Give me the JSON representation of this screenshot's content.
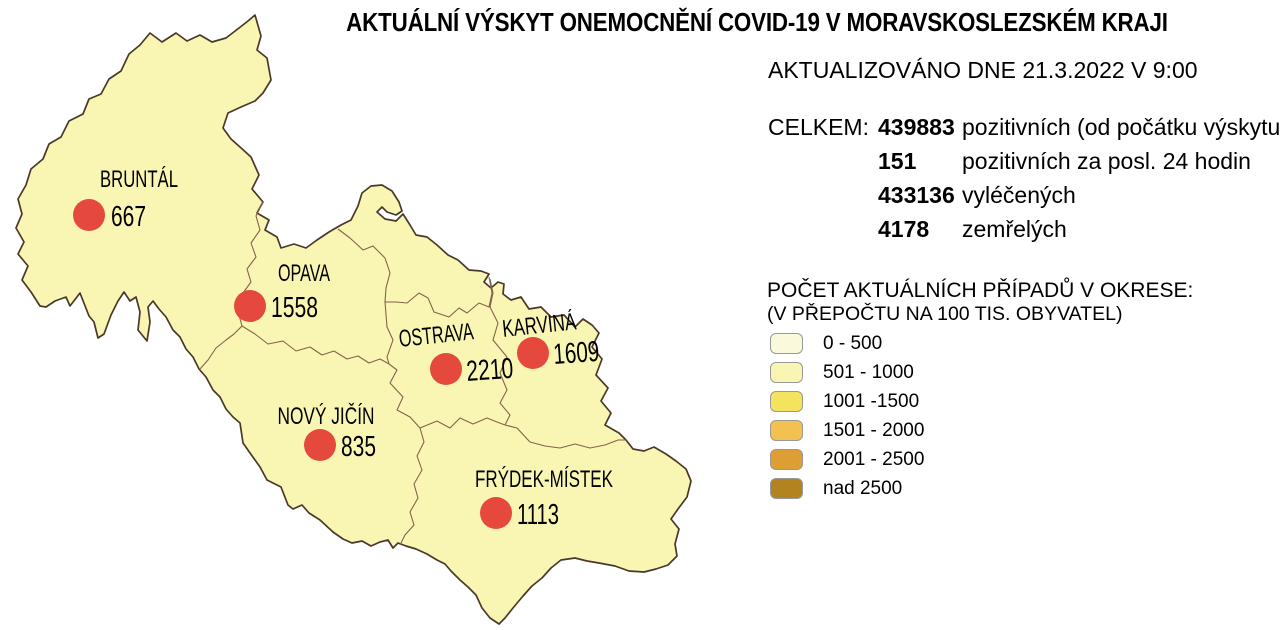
{
  "title": "AKTUÁLNÍ VÝSKYT ONEMOCNĚNÍ COVID-19 V MORAVSKOSLEZSKÉM KRAJI",
  "updated": "AKTUALIZOVÁNO DNE 21.3.2022 V 9:00",
  "totals": {
    "label": "CELKEM:",
    "rows": [
      {
        "value": "439883",
        "text": "pozitivních (od počátku výskytu)"
      },
      {
        "value": "151",
        "text": "pozitivních za posl. 24 hodin"
      },
      {
        "value": "433136",
        "text": "vyléčených"
      },
      {
        "value": "4178",
        "text": "zemřelých"
      }
    ]
  },
  "legend": {
    "title": "POČET AKTUÁLNÍCH PŘÍPADŮ V OKRESE:",
    "subtitle": "(V PŘEPOČTU NA 100 TIS. OBYVATEL)",
    "items": [
      {
        "label": "0 - 500",
        "color": "#FBF9DC"
      },
      {
        "label": "501 - 1000",
        "color": "#F9F6B4"
      },
      {
        "label": "1001 -1500",
        "color": "#F3E35F"
      },
      {
        "label": "1501 - 2000",
        "color": "#F2C14F"
      },
      {
        "label": "2001 - 2500",
        "color": "#DD9F35"
      },
      {
        "label": "nad 2500",
        "color": "#B3831F"
      }
    ]
  },
  "map": {
    "fill": "#F9F6B4",
    "border_color": "#4A3828",
    "district_border_color": "#84634A",
    "marker_color": "#E5483C",
    "districts": [
      {
        "name": "BRUNTÁL",
        "value": "667"
      },
      {
        "name": "OPAVA",
        "value": "1558"
      },
      {
        "name": "OSTRAVA",
        "value": "2210"
      },
      {
        "name": "KARVINÁ",
        "value": "1609"
      },
      {
        "name": "NOVÝ JIČÍN",
        "value": "835"
      },
      {
        "name": "FRÝDEK-MÍSTEK",
        "value": "1113"
      }
    ]
  }
}
